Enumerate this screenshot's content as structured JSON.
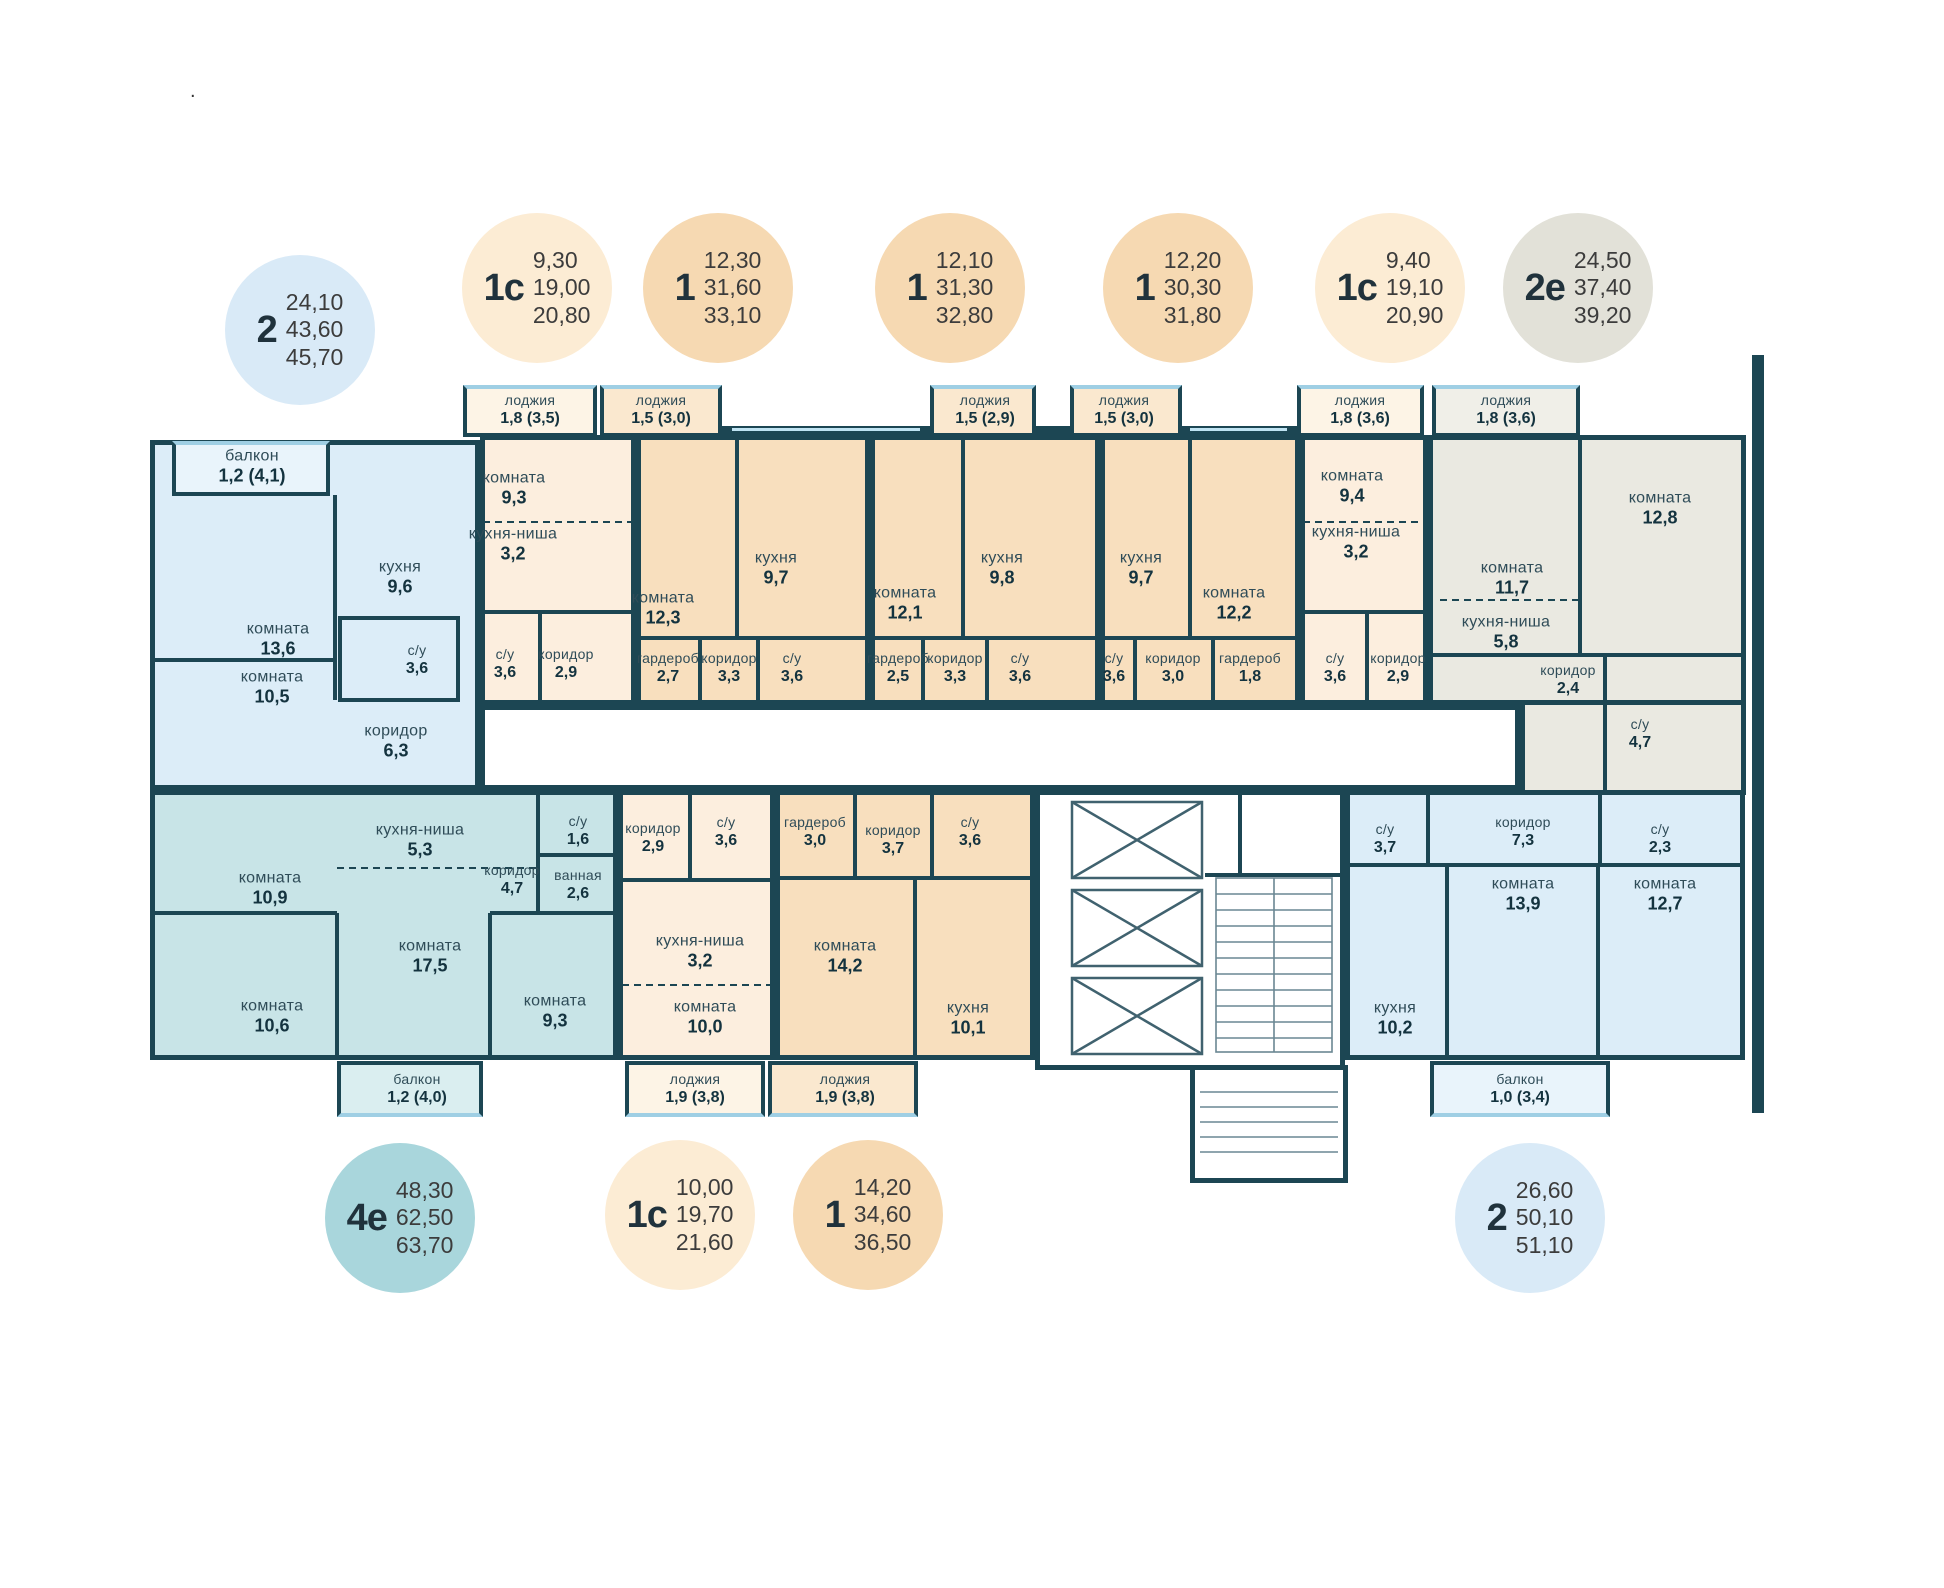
{
  "note_dot": ".",
  "colors": {
    "wall": "#1c4653",
    "apartment_blue": "#dcedf8",
    "apartment_peach": "#fceede",
    "apartment_orange": "#f8dfbe",
    "apartment_teal": "#c8e4e7",
    "apartment_gray": "#eae9e1",
    "circle_blue": "#d9eaf7",
    "circle_peach": "#fcecd4",
    "circle_orange": "#f6d9b2",
    "circle_teal": "#a9d6dc",
    "circle_gray": "#e2e1d8",
    "window": "#bfe3f2"
  },
  "legend": {
    "top": [
      {
        "type": "2",
        "areas": [
          "24,10",
          "43,60",
          "45,70"
        ]
      },
      {
        "type": "1с",
        "areas": [
          "9,30",
          "19,00",
          "20,80"
        ]
      },
      {
        "type": "1",
        "areas": [
          "12,30",
          "31,60",
          "33,10"
        ]
      },
      {
        "type": "1",
        "areas": [
          "12,10",
          "31,30",
          "32,80"
        ]
      },
      {
        "type": "1",
        "areas": [
          "12,20",
          "30,30",
          "31,80"
        ]
      },
      {
        "type": "1с",
        "areas": [
          "9,40",
          "19,10",
          "20,90"
        ]
      },
      {
        "type": "2е",
        "areas": [
          "24,50",
          "37,40",
          "39,20"
        ]
      }
    ],
    "bottom": [
      {
        "type": "4е",
        "areas": [
          "48,30",
          "62,50",
          "63,70"
        ]
      },
      {
        "type": "1с",
        "areas": [
          "10,00",
          "19,70",
          "21,60"
        ]
      },
      {
        "type": "1",
        "areas": [
          "14,20",
          "34,60",
          "36,50"
        ]
      },
      {
        "type": "2",
        "areas": [
          "26,60",
          "50,10",
          "51,10"
        ]
      }
    ]
  },
  "rooms": {
    "a1": {
      "name": "балкон",
      "area": "1,2 (4,1)"
    },
    "a2": {
      "name": "кухня",
      "area": "9,6"
    },
    "a3": {
      "name": "комната",
      "area": "13,6"
    },
    "a4": {
      "name": "комната",
      "area": "10,5"
    },
    "a5": {
      "name": "с/у",
      "area": "3,6"
    },
    "a6": {
      "name": "коридор",
      "area": "6,3"
    },
    "b1": {
      "name": "лоджия",
      "area": "1,8 (3,5)"
    },
    "b2": {
      "name": "комната",
      "area": "9,3"
    },
    "b3": {
      "name": "кухня-ниша",
      "area": "3,2"
    },
    "b4": {
      "name": "с/у",
      "area": "3,6"
    },
    "b5": {
      "name": "коридор",
      "area": "2,9"
    },
    "c1": {
      "name": "лоджия",
      "area": "1,5 (3,0)"
    },
    "c2": {
      "name": "комната",
      "area": "12,3"
    },
    "c3": {
      "name": "кухня",
      "area": "9,7"
    },
    "c4": {
      "name": "гардероб",
      "area": "2,7"
    },
    "c5": {
      "name": "коридор",
      "area": "3,3"
    },
    "c6": {
      "name": "с/у",
      "area": "3,6"
    },
    "d1": {
      "name": "лоджия",
      "area": "1,5 (2,9)"
    },
    "d2": {
      "name": "комната",
      "area": "12,1"
    },
    "d3": {
      "name": "кухня",
      "area": "9,8"
    },
    "d4": {
      "name": "гардероб",
      "area": "2,5"
    },
    "d5": {
      "name": "коридор",
      "area": "3,3"
    },
    "d6": {
      "name": "с/у",
      "area": "3,6"
    },
    "e1": {
      "name": "лоджия",
      "area": "1,5 (3,0)"
    },
    "e2": {
      "name": "кухня",
      "area": "9,7"
    },
    "e3": {
      "name": "комната",
      "area": "12,2"
    },
    "e4": {
      "name": "с/у",
      "area": "3,6"
    },
    "e5": {
      "name": "коридор",
      "area": "3,0"
    },
    "e6": {
      "name": "гардероб",
      "area": "1,8"
    },
    "f1": {
      "name": "лоджия",
      "area": "1,8 (3,6)"
    },
    "f2": {
      "name": "комната",
      "area": "9,4"
    },
    "f3": {
      "name": "кухня-ниша",
      "area": "3,2"
    },
    "f4": {
      "name": "с/у",
      "area": "3,6"
    },
    "f5": {
      "name": "коридор",
      "area": "2,9"
    },
    "g1": {
      "name": "лоджия",
      "area": "1,8 (3,6)"
    },
    "g2": {
      "name": "комната",
      "area": "11,7"
    },
    "g3": {
      "name": "кухня-ниша",
      "area": "5,8"
    },
    "g4": {
      "name": "комната",
      "area": "12,8"
    },
    "g5": {
      "name": "коридор",
      "area": "2,4"
    },
    "g6": {
      "name": "с/у",
      "area": "4,7"
    },
    "h1": {
      "name": "комната",
      "area": "10,9"
    },
    "h2": {
      "name": "комната",
      "area": "10,6"
    },
    "h3": {
      "name": "кухня-ниша",
      "area": "5,3"
    },
    "h4": {
      "name": "комната",
      "area": "17,5"
    },
    "h5": {
      "name": "коридор",
      "area": "4,7"
    },
    "h6": {
      "name": "с/у",
      "area": "1,6"
    },
    "h7": {
      "name": "ванная",
      "area": "2,6"
    },
    "h8": {
      "name": "комната",
      "area": "9,3"
    },
    "h9": {
      "name": "балкон",
      "area": "1,2 (4,0)"
    },
    "i1": {
      "name": "коридор",
      "area": "2,9"
    },
    "i2": {
      "name": "с/у",
      "area": "3,6"
    },
    "i3": {
      "name": "кухня-ниша",
      "area": "3,2"
    },
    "i4": {
      "name": "комната",
      "area": "10,0"
    },
    "i5": {
      "name": "лоджия",
      "area": "1,9 (3,8)"
    },
    "j1": {
      "name": "гардероб",
      "area": "3,0"
    },
    "j2": {
      "name": "коридор",
      "area": "3,7"
    },
    "j3": {
      "name": "с/у",
      "area": "3,6"
    },
    "j4": {
      "name": "комната",
      "area": "14,2"
    },
    "j5": {
      "name": "кухня",
      "area": "10,1"
    },
    "j6": {
      "name": "лоджия",
      "area": "1,9 (3,8)"
    },
    "k1": {
      "name": "с/у",
      "area": "3,7"
    },
    "k2": {
      "name": "коридор",
      "area": "7,3"
    },
    "k3": {
      "name": "с/у",
      "area": "2,3"
    },
    "k4": {
      "name": "комната",
      "area": "13,9"
    },
    "k5": {
      "name": "комната",
      "area": "12,7"
    },
    "k6": {
      "name": "кухня",
      "area": "10,2"
    },
    "k7": {
      "name": "балкон",
      "area": "1,0 (3,4)"
    }
  }
}
